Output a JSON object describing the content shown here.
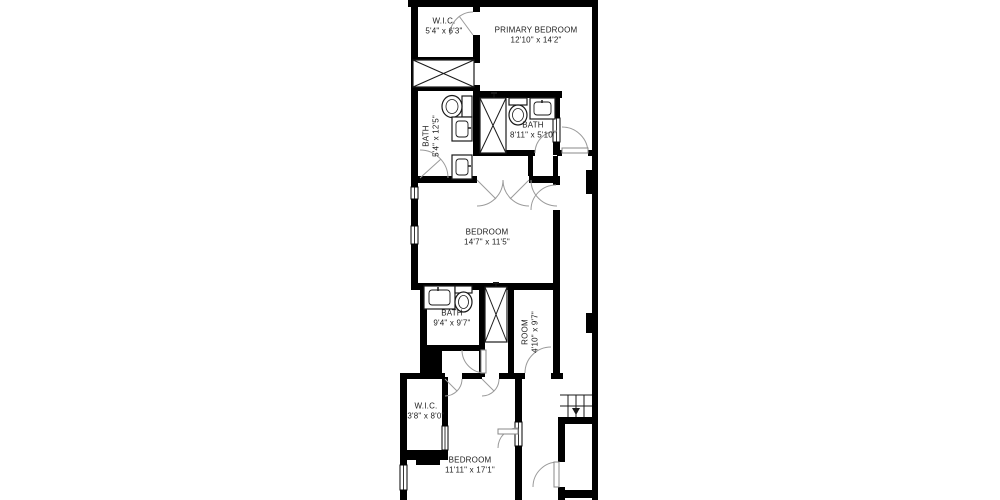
{
  "floorplan": {
    "background_color": "#ffffff",
    "wall_color": "#000000",
    "door_arc_color": "#9a9a9a",
    "fixture_line_color": "#1a1a1a",
    "rooms": [
      {
        "name": "W.I.C.",
        "dims": "5'4\" x 6'3\""
      },
      {
        "name": "PRIMARY BEDROOM",
        "dims": "12'10\" x 14'2\""
      },
      {
        "name": "BATH",
        "dims": "5'4\" x 12'5\""
      },
      {
        "name": "BATH",
        "dims": "8'11\" x 5'10\""
      },
      {
        "name": "BEDROOM",
        "dims": "14'7\" x 11'5\""
      },
      {
        "name": "BATH",
        "dims": "9'4\" x 9'7\""
      },
      {
        "name": "ROOM",
        "dims": "4'10\" x 9'7\""
      },
      {
        "name": "W.I.C.",
        "dims": "3'8\" x 8'0\""
      },
      {
        "name": "BEDROOM",
        "dims": "11'11\" x 17'1\""
      }
    ],
    "stairs": {
      "direction": "down"
    }
  }
}
